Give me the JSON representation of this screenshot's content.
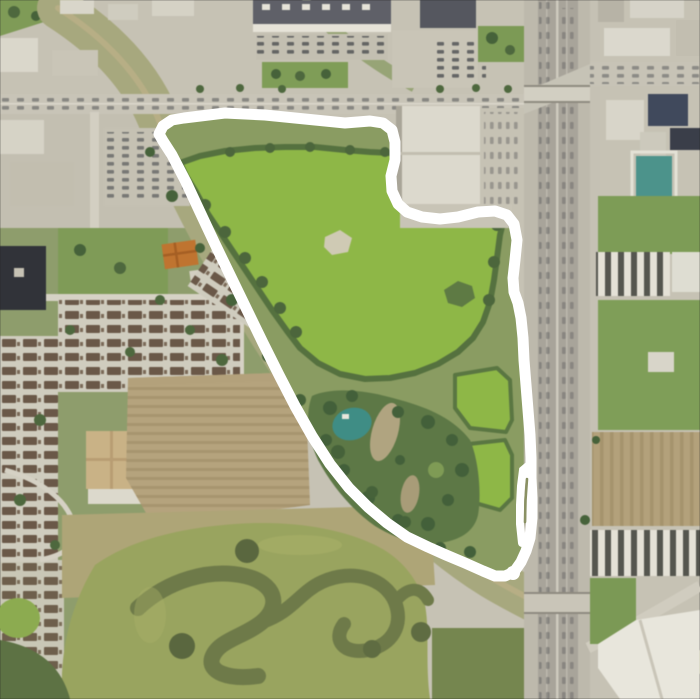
{
  "map": {
    "description": "Aerial satellite view of a green pond park outlined with a hand-drawn white loop, bounded by a freeway on the east, commercial blocks north, residential neighborhoods west and a serpentine constructed wetland to the south",
    "annotation": {
      "type": "freehand-loop",
      "color": "#ffffff",
      "stroke_width": 11
    },
    "palette": {
      "urban": "#c8c4b6",
      "road": "#c9c5b8",
      "highway": "#bdb9ac",
      "highway_lanes": "#a8a49a",
      "lake_green": "#8eb747",
      "park_green": "#8a9c62",
      "field_green": "#7d9c56",
      "trees_dark": "#4e683e",
      "corridor": "#a7a87e",
      "creek": "#b7ae85",
      "wetland": "#99a45f",
      "wetland_channel": "#6e7a49",
      "field_brown": "#b3a17b",
      "roofs_brown": "#6a5848",
      "roof_dark": "#40495c",
      "building_white": "#dedbd0",
      "building_dark": "#313339",
      "roof_orange": "#bf7430",
      "teal_feature": "#3f8d85",
      "white_line": "#ffffff"
    },
    "regions": {
      "northwest": "commercial-retail-blocks",
      "north": "office-parking-complex",
      "east": "freeway-corridor-with-commercial",
      "center": "pond-park-inside-white-loop",
      "west": "townhouse-residential",
      "southwest": "tilled-field-and-serpentine-wetland",
      "diagonal": "creek-greenway-corridor"
    }
  }
}
